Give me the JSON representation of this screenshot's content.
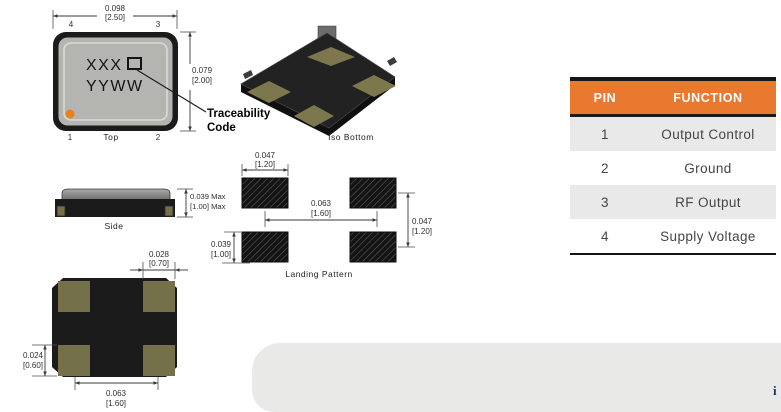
{
  "views": {
    "top": {
      "label": "Top",
      "marking_line1": "XXX",
      "marking_line2": "YYWW",
      "pin4": "4",
      "pin3": "3",
      "pin1": "1",
      "pin2": "2",
      "width_in": "0.098",
      "width_mm": "[2.50]",
      "height_in": "0.079",
      "height_mm": "[2.00]",
      "callout_line1": "Traceability",
      "callout_line2": "Code"
    },
    "iso": {
      "label": "Iso Bottom"
    },
    "side": {
      "label": "Side",
      "height_in": "0.039 Max",
      "height_mm": "[1.00] Max"
    },
    "landing": {
      "label": "Landing Pattern",
      "pad_width_in": "0.047",
      "pad_width_mm": "[1.20]",
      "pitch_x_in": "0.063",
      "pitch_x_mm": "[1.60]",
      "pitch_y_in": "0.047",
      "pitch_y_mm": "[1.20]",
      "pad_height_in": "0.039",
      "pad_height_mm": "[1.00]"
    },
    "bottom": {
      "pad_width_in": "0.028",
      "pad_width_mm": "[0.70]",
      "pad_height_in": "0.024",
      "pad_height_mm": "[0.60]",
      "pitch_in": "0.063",
      "pitch_mm": "[1.60]"
    }
  },
  "pin_table": {
    "header": {
      "pin": "PIN",
      "function": "FUNCTION"
    },
    "rows": [
      {
        "pin": "1",
        "function": "Output Control"
      },
      {
        "pin": "2",
        "function": "Ground"
      },
      {
        "pin": "3",
        "function": "RF Output"
      },
      {
        "pin": "4",
        "function": "Supply Voltage"
      }
    ]
  },
  "watermark": {
    "fragment": "i"
  },
  "colors": {
    "table_header_bg": "#E8792E",
    "table_row_alt_bg": "#E9E9E9",
    "package_black": "#1B1B1B",
    "pad_tan": "#74704A",
    "pin1_dot_orange": "#E8821D",
    "watermark_gray": "#E9E9E8",
    "watermark_text_blue": "#16365C"
  }
}
